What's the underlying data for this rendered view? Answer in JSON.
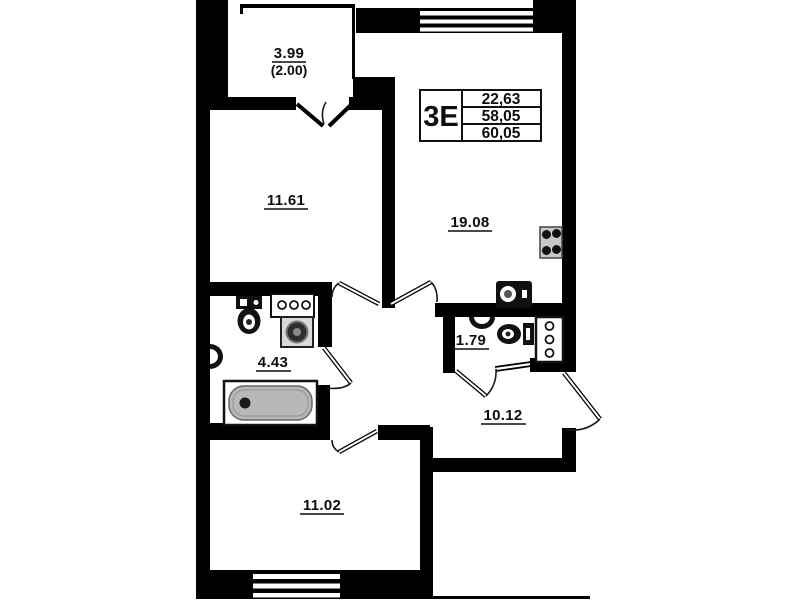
{
  "plan": {
    "type_box": {
      "type": "3Е",
      "values": [
        "22,63",
        "58,05",
        "60,05"
      ]
    },
    "rooms": {
      "loggia": {
        "area": "3.99",
        "area_coef": "(2.00)"
      },
      "room1": {
        "area": "11.61"
      },
      "kitchen_living": {
        "area": "19.08"
      },
      "bathroom": {
        "area": "4.43"
      },
      "wc": {
        "area": "1.79"
      },
      "hallway": {
        "area": "10.12"
      },
      "room2": {
        "area": "11.02"
      }
    },
    "colors": {
      "wall": "#000000",
      "background": "#ffffff",
      "bathtub_fill": "#b8b8b8",
      "stove_fill": "#c8c8c8",
      "washer_fill": "#d9d9d9"
    }
  }
}
